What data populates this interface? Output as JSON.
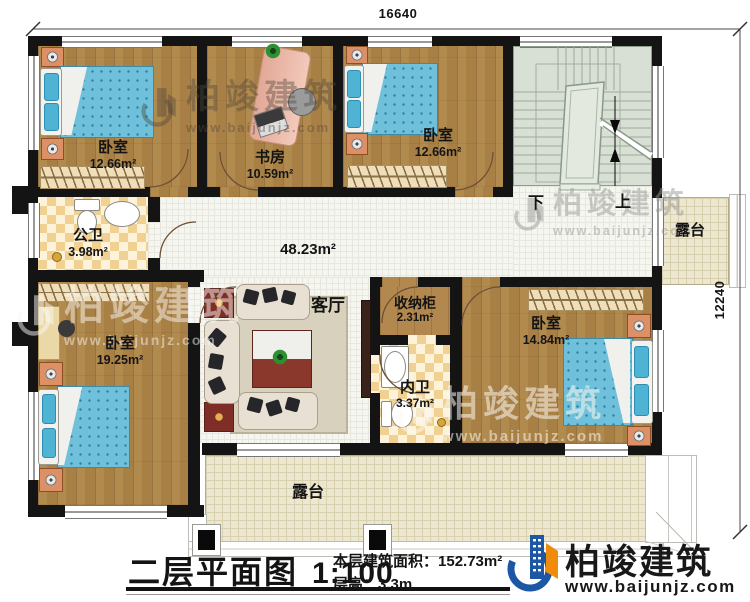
{
  "dimensions": {
    "top": "16640",
    "right": "12240"
  },
  "rooms": {
    "bedroom_top_left": {
      "name": "卧室",
      "area": "12.66m²"
    },
    "study": {
      "name": "书房",
      "area": "10.59m²"
    },
    "bedroom_top_right": {
      "name": "卧室",
      "area": "12.66m²"
    },
    "public_bathroom": {
      "name": "公卫",
      "area": "3.98m²"
    },
    "hall": {
      "area": "48.23m²"
    },
    "living_room": {
      "name": "客厅"
    },
    "storage_cabinet": {
      "name": "收纳柜",
      "area": "2.31m²"
    },
    "inner_bathroom": {
      "name": "内卫",
      "area": "3.37m²"
    },
    "bedroom_right": {
      "name": "卧室",
      "area": "14.84m²"
    },
    "bedroom_bottom_left": {
      "name": "卧室",
      "area": "19.25m²"
    },
    "terrace_right": {
      "name": "露台"
    },
    "terrace_bottom": {
      "name": "露台"
    }
  },
  "stairs": {
    "down_label": "下",
    "up_label": "上"
  },
  "title_block": {
    "plan_name": "二层平面图",
    "scale": "1:100",
    "floor_area_label": "本层建筑面积：",
    "floor_area_value": "152.73m²",
    "floor_height_label": "层高：",
    "floor_height_value": "3.3m"
  },
  "logo": {
    "company": "柏竣建筑",
    "website": "www.baijunjz.com"
  },
  "watermark": {
    "company": "柏竣建筑",
    "website": "www.baijunjz.com"
  },
  "colors": {
    "wall": "#141414",
    "wood_floor": "#a87f44",
    "bed_blue": "#6fc0da",
    "stairs_floor": "#d8dfd4",
    "terrace_floor": "#ece7d0",
    "tile_floor": "#f6f6f1",
    "checker_tile": "#f0d191",
    "logo_blue": "#1c57a5",
    "logo_orange": "#f08c0a"
  }
}
